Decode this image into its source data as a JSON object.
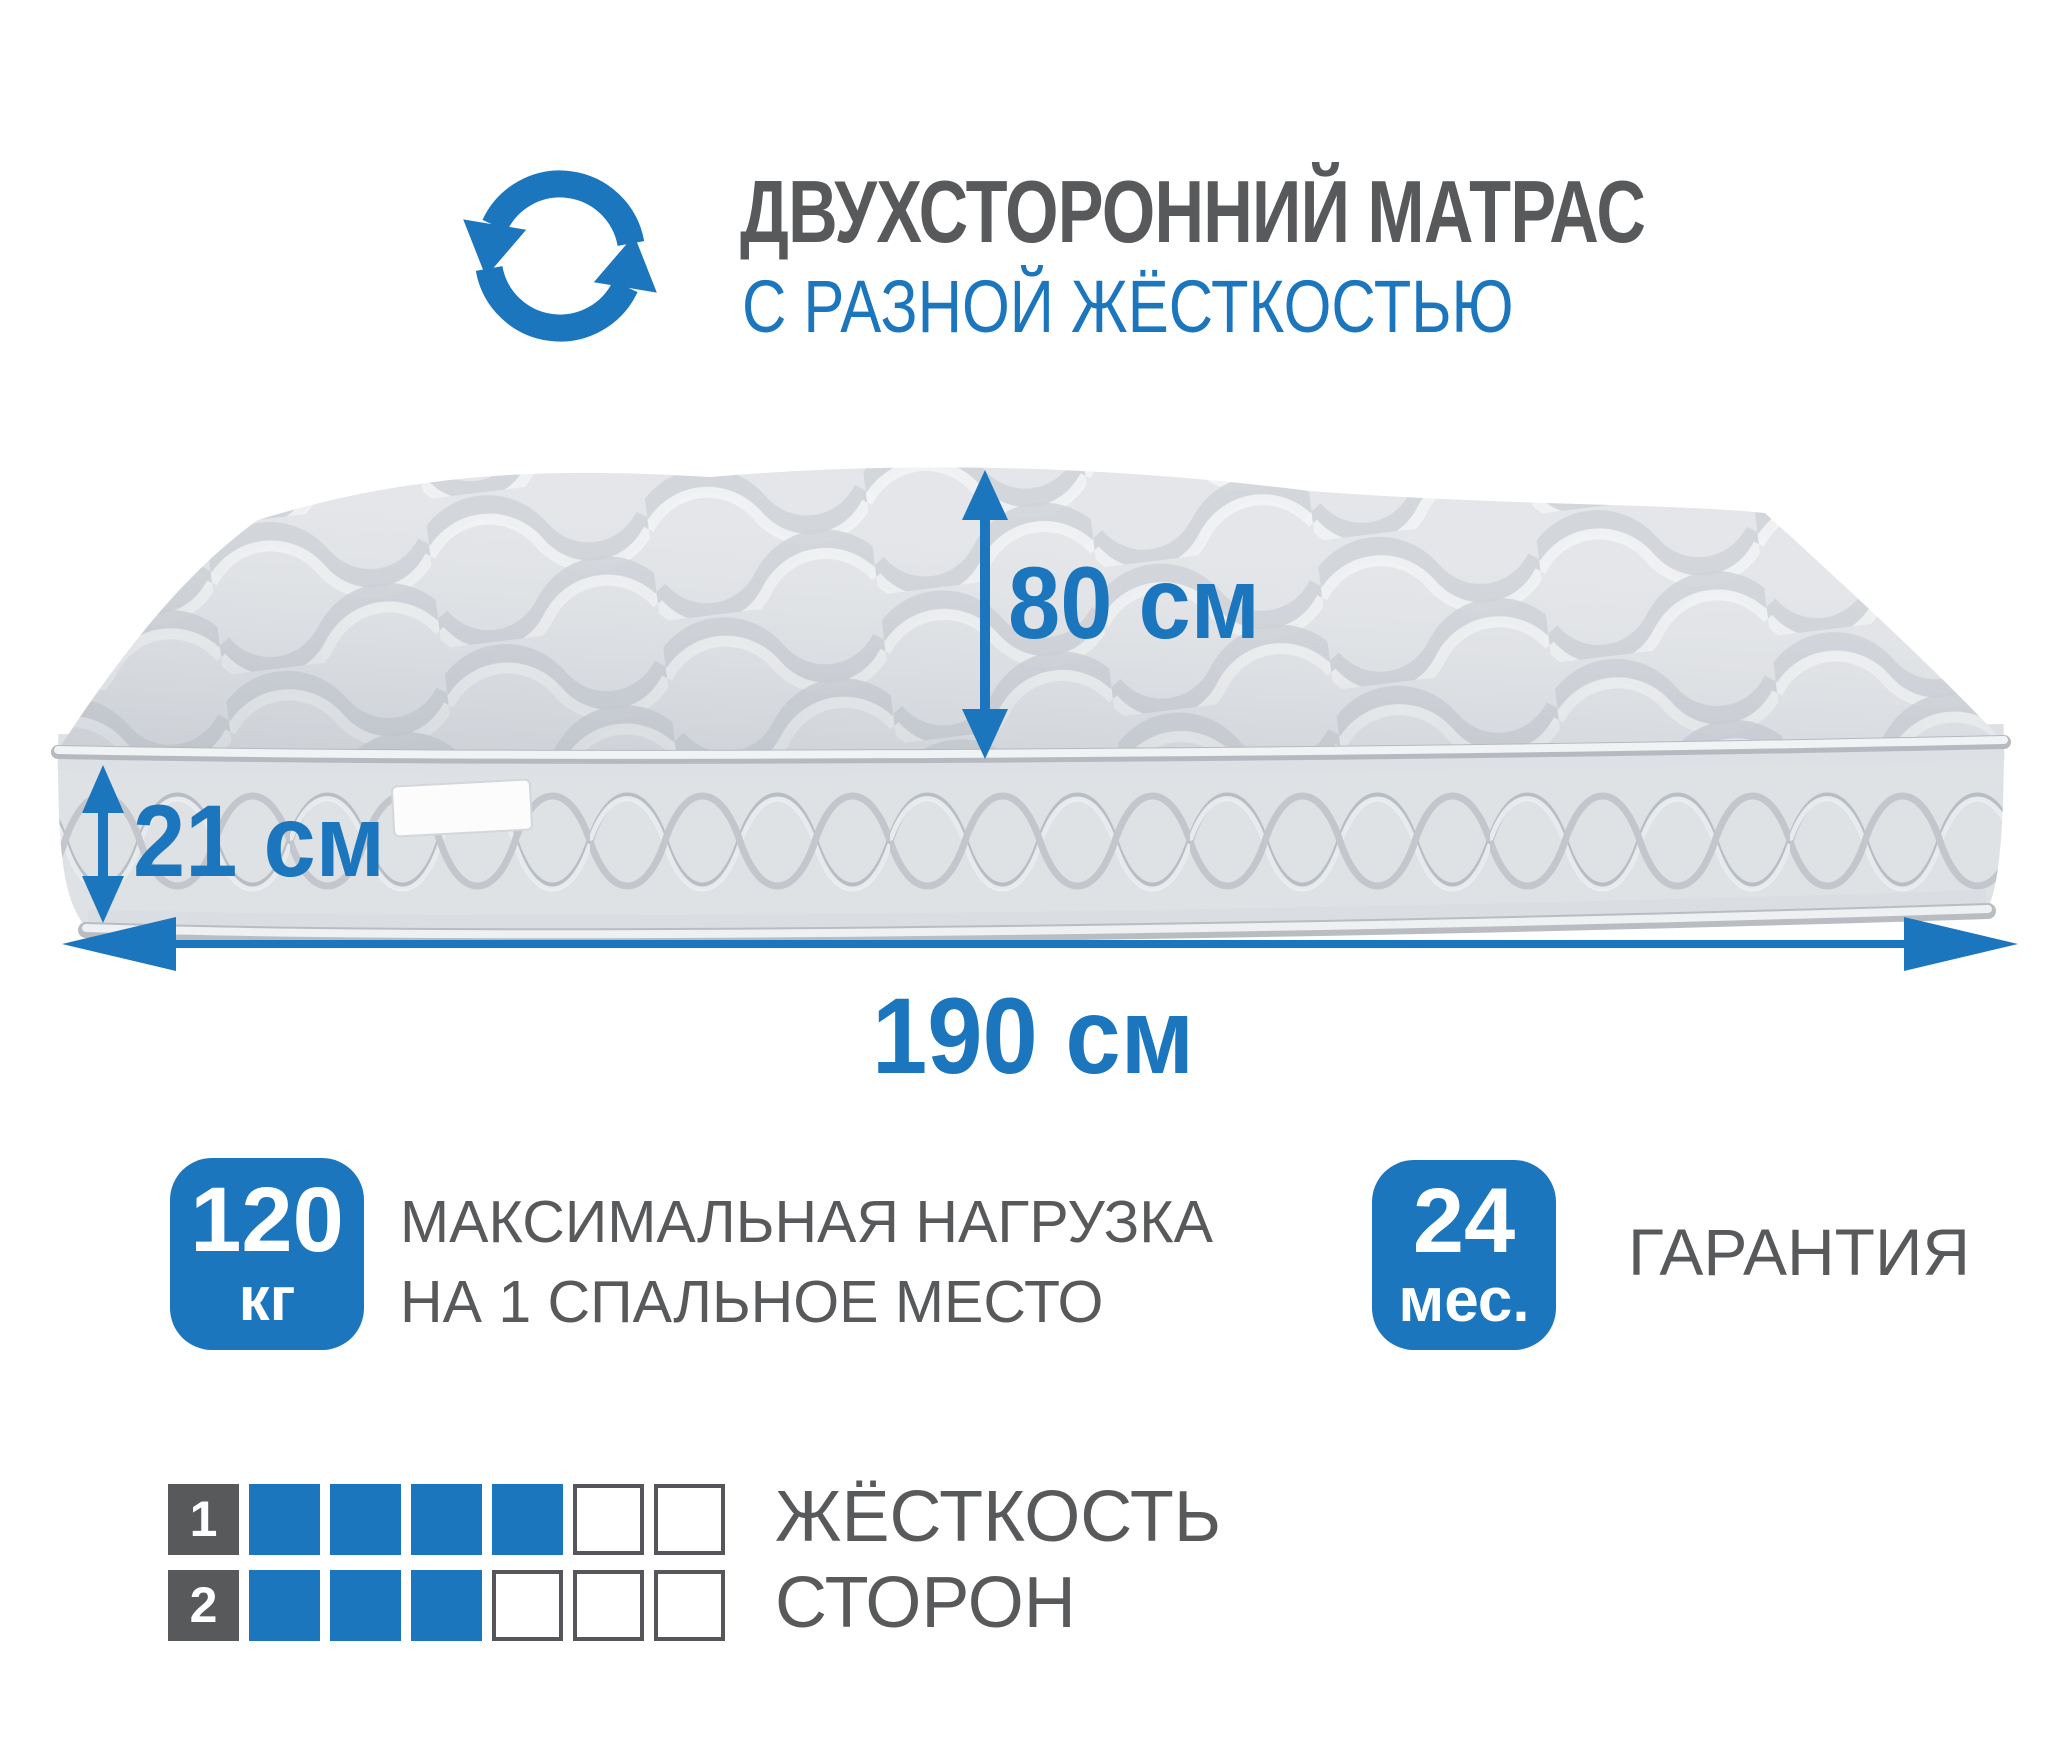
{
  "colors": {
    "accent_blue": "#1b76bd",
    "text_gray": "#58595b",
    "mattress_top": "#e4e6e9",
    "mattress_side": "#dfe2e5"
  },
  "header": {
    "icon": "rotate-arrows-icon",
    "title": "ДВУХСТОРОННИЙ МАТРАС",
    "subtitle": "С РАЗНОЙ ЖЁСТКОСТЬЮ"
  },
  "mattress": {
    "image": "quilted-mattress-perspective",
    "tag": "blank-label-tag",
    "height_label": "80 см",
    "thickness_label": "21 см",
    "width_label": "190 см"
  },
  "max_load": {
    "value": "120",
    "unit": "кг",
    "line1": "МАКСИМАЛЬНАЯ НАГРУЗКА",
    "line2": "НА 1 СПАЛЬНОЕ МЕСТО"
  },
  "warranty": {
    "value": "24",
    "unit": "мес.",
    "label": "ГАРАНТИЯ"
  },
  "firmness": {
    "label_line1": "ЖЁСТКОСТЬ",
    "label_line2": "СТОРОН",
    "scale_max": 6,
    "sides": [
      {
        "side": "1",
        "value": 4
      },
      {
        "side": "2",
        "value": 3
      }
    ]
  }
}
